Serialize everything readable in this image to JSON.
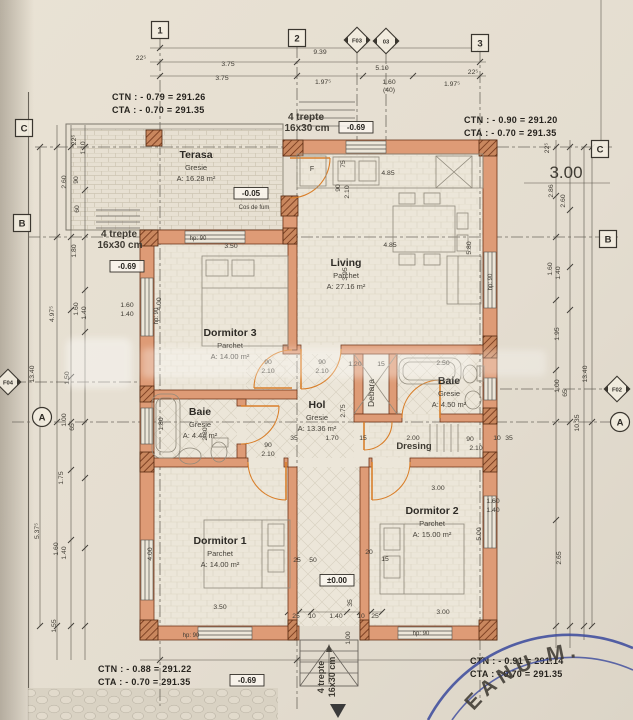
{
  "drawing": {
    "corner_notes": [
      {
        "l1": "CTN :  - 0.79 = 291.26",
        "l2": "CTA :  - 0.70 = 291.35",
        "x": 112,
        "y": 100
      },
      {
        "l1": "CTN :  - 0.90 = 291.20",
        "l2": "CTA :  - 0.70 = 291.35",
        "x": 464,
        "y": 123
      },
      {
        "l1": "CTN :  - 0.88 = 291.22",
        "l2": "CTA :  - 0.70 = 291.35",
        "x": 98,
        "y": 672
      },
      {
        "l1": "CTN :  - 0.91 = 291.14",
        "l2": "CTA :  - 0.70 = 291.35",
        "x": 470,
        "y": 664
      }
    ],
    "grid_bubbles": [
      {
        "label": "1",
        "shape": "square",
        "x": 160,
        "y": 30
      },
      {
        "label": "2",
        "shape": "square",
        "x": 297,
        "y": 38
      },
      {
        "label": "F03",
        "shape": "diamond",
        "x": 357,
        "y": 40
      },
      {
        "label": "03",
        "shape": "diamond",
        "x": 386,
        "y": 41
      },
      {
        "label": "3",
        "shape": "square",
        "x": 480,
        "y": 43
      },
      {
        "label": "C",
        "shape": "square",
        "x": 24,
        "y": 128
      },
      {
        "label": "B",
        "shape": "square",
        "x": 22,
        "y": 223
      },
      {
        "label": "F04",
        "shape": "diamond",
        "x": 8,
        "y": 382
      },
      {
        "label": "A",
        "shape": "circle",
        "x": 42,
        "y": 417
      },
      {
        "label": "C",
        "shape": "square",
        "x": 600,
        "y": 149
      },
      {
        "label": "B",
        "shape": "square",
        "x": 608,
        "y": 239
      },
      {
        "label": "F02",
        "shape": "diamond",
        "x": 617,
        "y": 389
      },
      {
        "label": "A",
        "shape": "circle",
        "x": 620,
        "y": 422
      }
    ],
    "rooms": [
      {
        "name": "Terasa",
        "finish": "Gresie",
        "area": "A: 16.28 m²",
        "x": 196,
        "y": 158
      },
      {
        "name": "Living",
        "finish": "Parchet",
        "area": "A: 27.16 m²",
        "x": 346,
        "y": 266
      },
      {
        "name": "Dormitor 3",
        "finish": "Parchet",
        "area": "A: 14.00 m²",
        "x": 230,
        "y": 336
      },
      {
        "name": "Baie",
        "finish": "Gresie",
        "area": "A: 4.44 m²",
        "x": 200,
        "y": 415
      },
      {
        "name": "Hol",
        "finish": "Gresie",
        "area": "A: 13.36 m²",
        "x": 317,
        "y": 408
      },
      {
        "name": "Baie",
        "finish": "Gresie",
        "area": "A: 4.50 m²",
        "x": 449,
        "y": 384
      },
      {
        "name": "Dormitor 1",
        "finish": "Parchet",
        "area": "A: 14.00 m²",
        "x": 220,
        "y": 544
      },
      {
        "name": "Dormitor 2",
        "finish": "Parchet",
        "area": "A: 15.00 m²",
        "x": 432,
        "y": 514
      }
    ],
    "levels": [
      {
        "t": "-0.05",
        "x": 251,
        "y": 196
      },
      {
        "t": "-0.69",
        "x": 356,
        "y": 130
      },
      {
        "t": "-0.69",
        "x": 127,
        "y": 269
      },
      {
        "t": "±0.00",
        "x": 337,
        "y": 583
      },
      {
        "t": "-0.69",
        "x": 247,
        "y": 683
      }
    ],
    "dimensions": [
      {
        "t": "9.39",
        "x": 320,
        "y": 54
      },
      {
        "t": "22⁵",
        "x": 141,
        "y": 60
      },
      {
        "t": "3.75",
        "x": 228,
        "y": 66
      },
      {
        "t": "5.10",
        "x": 382,
        "y": 70
      },
      {
        "t": "22⁵",
        "x": 473,
        "y": 74
      },
      {
        "t": "3.75",
        "x": 222,
        "y": 80
      },
      {
        "t": "1.97⁵",
        "x": 323,
        "y": 84
      },
      {
        "t": "1.60",
        "x": 389,
        "y": 84
      },
      {
        "t": "(40)",
        "x": 389,
        "y": 92
      },
      {
        "t": "1.97⁵",
        "x": 452,
        "y": 86
      },
      {
        "t": "22⁵",
        "x": 76,
        "y": 140,
        "r": -90
      },
      {
        "t": "1.10",
        "x": 85,
        "y": 148,
        "r": -90
      },
      {
        "t": "2.60",
        "x": 66,
        "y": 182,
        "r": -90
      },
      {
        "t": "90",
        "x": 78,
        "y": 180,
        "r": -90
      },
      {
        "t": "60",
        "x": 79,
        "y": 209,
        "r": -90
      },
      {
        "t": "1.80",
        "x": 76,
        "y": 251,
        "r": -90
      },
      {
        "t": "4.97⁵",
        "x": 54,
        "y": 314,
        "r": -90
      },
      {
        "t": "1.60",
        "x": 78,
        "y": 309,
        "r": -90
      },
      {
        "t": "1.40",
        "x": 86,
        "y": 313,
        "r": -90
      },
      {
        "t": "13.40",
        "x": 34,
        "y": 374,
        "r": -90
      },
      {
        "t": "1.50",
        "x": 69,
        "y": 378,
        "r": -90
      },
      {
        "t": "1.00",
        "x": 66,
        "y": 420,
        "r": -90
      },
      {
        "t": "65",
        "x": 74,
        "y": 427,
        "r": -90
      },
      {
        "t": "1.75",
        "x": 63,
        "y": 478,
        "r": -90
      },
      {
        "t": "5.37⁵",
        "x": 39,
        "y": 531,
        "r": -90
      },
      {
        "t": "1.60",
        "x": 58,
        "y": 549,
        "r": -90
      },
      {
        "t": "1.40",
        "x": 66,
        "y": 553,
        "r": -90
      },
      {
        "t": "1.55",
        "x": 56,
        "y": 626,
        "r": -90
      },
      {
        "t": "3.00",
        "x": 566,
        "y": 178,
        "s": 17
      },
      {
        "t": "22⁵",
        "x": 549,
        "y": 148,
        "r": -90
      },
      {
        "t": "2.86",
        "x": 553,
        "y": 191,
        "r": -90
      },
      {
        "t": "2.60",
        "x": 565,
        "y": 201,
        "r": -90
      },
      {
        "t": "1.60",
        "x": 552,
        "y": 269,
        "r": -90
      },
      {
        "t": "1.40",
        "x": 560,
        "y": 273,
        "r": -90
      },
      {
        "t": "1.95",
        "x": 559,
        "y": 334,
        "r": -90
      },
      {
        "t": "1.00",
        "x": 559,
        "y": 386,
        "r": -90
      },
      {
        "t": "65",
        "x": 567,
        "y": 393,
        "r": -90
      },
      {
        "t": "13.40",
        "x": 587,
        "y": 374,
        "r": -90
      },
      {
        "t": "10.35",
        "x": 579,
        "y": 423,
        "r": -90
      },
      {
        "t": "2.65",
        "x": 561,
        "y": 558,
        "r": -90
      },
      {
        "t": "25",
        "x": 296,
        "y": 618
      },
      {
        "t": "10",
        "x": 312,
        "y": 618
      },
      {
        "t": "1.40",
        "x": 336,
        "y": 618
      },
      {
        "t": "10",
        "x": 361,
        "y": 618
      },
      {
        "t": "25",
        "x": 375,
        "y": 618
      },
      {
        "t": "35",
        "x": 352,
        "y": 603,
        "r": -90
      },
      {
        "t": "1.00",
        "x": 350,
        "y": 638,
        "r": -90
      },
      {
        "t": "3.50",
        "x": 231,
        "y": 248
      },
      {
        "t": "4.85",
        "x": 388,
        "y": 175
      },
      {
        "t": "75",
        "x": 345,
        "y": 164,
        "r": -90
      },
      {
        "t": "90",
        "x": 340,
        "y": 188,
        "r": -90
      },
      {
        "t": "2.10",
        "x": 349,
        "y": 192,
        "r": -90
      },
      {
        "t": "4.85",
        "x": 390,
        "y": 247
      },
      {
        "t": "3.95",
        "x": 347,
        "y": 274,
        "r": -90
      },
      {
        "t": "5.80",
        "x": 471,
        "y": 248,
        "r": -90
      },
      {
        "t": "4.00",
        "x": 161,
        "y": 304,
        "r": -90
      },
      {
        "t": "1.60",
        "x": 127,
        "y": 307
      },
      {
        "t": "1.40",
        "x": 127,
        "y": 316
      },
      {
        "t": "90",
        "x": 268,
        "y": 364
      },
      {
        "t": "2.10",
        "x": 268,
        "y": 373
      },
      {
        "t": "90",
        "x": 322,
        "y": 364
      },
      {
        "t": "2.10",
        "x": 322,
        "y": 373
      },
      {
        "t": "1.20",
        "x": 355,
        "y": 366
      },
      {
        "t": "15",
        "x": 381,
        "y": 366
      },
      {
        "t": "2.50",
        "x": 443,
        "y": 365
      },
      {
        "t": "2.75",
        "x": 345,
        "y": 411,
        "r": -90
      },
      {
        "t": "1.80",
        "x": 163,
        "y": 424,
        "r": -90
      },
      {
        "t": "2.30",
        "x": 207,
        "y": 434,
        "r": -90
      },
      {
        "t": "1.70",
        "x": 332,
        "y": 440
      },
      {
        "t": "15",
        "x": 363,
        "y": 440
      },
      {
        "t": "35",
        "x": 294,
        "y": 440
      },
      {
        "t": "90",
        "x": 268,
        "y": 447
      },
      {
        "t": "2.10",
        "x": 268,
        "y": 456
      },
      {
        "t": "2.00",
        "x": 413,
        "y": 440
      },
      {
        "t": "90",
        "x": 470,
        "y": 441
      },
      {
        "t": "2.10",
        "x": 476,
        "y": 450
      },
      {
        "t": "10",
        "x": 497,
        "y": 440
      },
      {
        "t": "35",
        "x": 509,
        "y": 440
      },
      {
        "t": "4.00",
        "x": 152,
        "y": 554,
        "r": -90
      },
      {
        "t": "3.50",
        "x": 220,
        "y": 609
      },
      {
        "t": "25",
        "x": 297,
        "y": 562
      },
      {
        "t": "50",
        "x": 313,
        "y": 562
      },
      {
        "t": "3.00",
        "x": 438,
        "y": 490
      },
      {
        "t": "5.00",
        "x": 481,
        "y": 534,
        "r": -90
      },
      {
        "t": "3.00",
        "x": 443,
        "y": 614
      },
      {
        "t": "1.60",
        "x": 493,
        "y": 503
      },
      {
        "t": "1.40",
        "x": 493,
        "y": 512
      },
      {
        "t": "20",
        "x": 369,
        "y": 554
      },
      {
        "t": "15",
        "x": 385,
        "y": 561
      }
    ],
    "small_labels": [
      {
        "t": "4 trepte",
        "x": 119,
        "y": 237,
        "s": 10,
        "b": 1
      },
      {
        "t": "16x30 cm",
        "x": 120,
        "y": 248,
        "s": 10,
        "b": 1
      },
      {
        "t": "4 trepte",
        "x": 306,
        "y": 120,
        "s": 10,
        "b": 1
      },
      {
        "t": "16x30 cm",
        "x": 307,
        "y": 131,
        "s": 10,
        "b": 1
      },
      {
        "t": "4 trepte",
        "x": 324,
        "y": 677,
        "s": 9,
        "b": 1,
        "r": -90
      },
      {
        "t": "16x30 cm",
        "x": 335,
        "y": 677,
        "s": 9,
        "b": 1,
        "r": -90
      },
      {
        "t": "Cos de fum",
        "x": 254,
        "y": 209,
        "s": 6
      },
      {
        "t": "hp: 90",
        "x": 198,
        "y": 240,
        "s": 6
      },
      {
        "t": "hp: 90",
        "x": 158,
        "y": 316,
        "s": 6,
        "r": -90
      },
      {
        "t": "hp: 90",
        "x": 191,
        "y": 637,
        "s": 6
      },
      {
        "t": "hp: 90",
        "x": 421,
        "y": 635,
        "s": 6
      },
      {
        "t": "hp: 90",
        "x": 492,
        "y": 282,
        "s": 6,
        "r": -90
      },
      {
        "t": "Debara",
        "x": 374,
        "y": 393,
        "s": 8.5,
        "r": -90
      },
      {
        "t": "Dresing",
        "x": 414,
        "y": 449,
        "s": 9.5,
        "b": 1
      },
      {
        "t": "F",
        "x": 312,
        "y": 171,
        "s": 7
      }
    ],
    "stamp": {
      "text": "EANU M.",
      "color": "#3a499c"
    }
  }
}
